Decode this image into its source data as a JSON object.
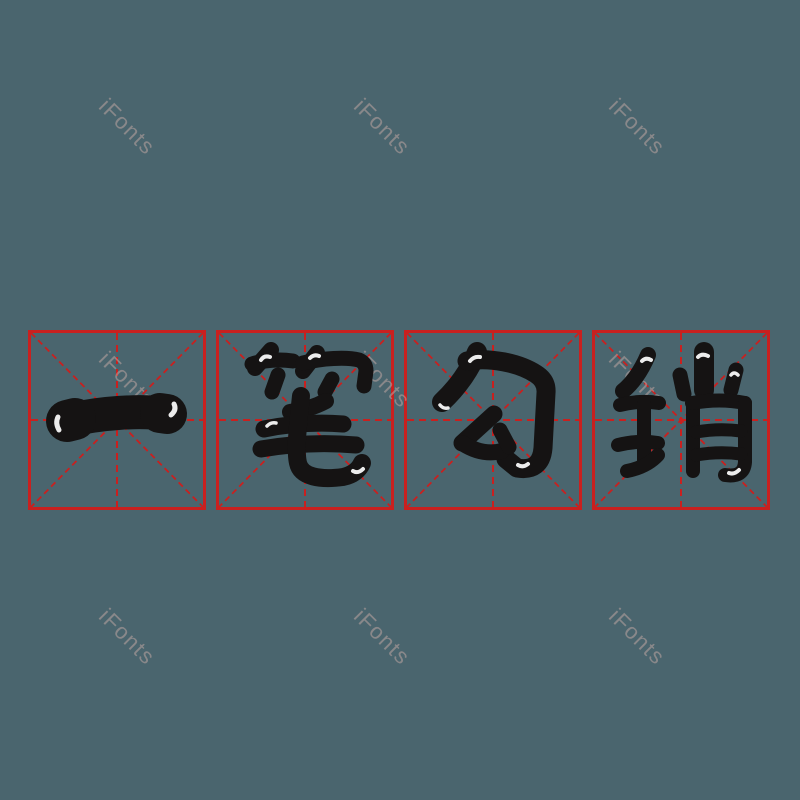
{
  "phrase": {
    "text": "一笔勾销"
  },
  "characters": [
    "一",
    "笔",
    "勾",
    "销"
  ],
  "watermark": {
    "text": "iFonts"
  },
  "grid": {
    "cell_count": 4
  },
  "colors": {
    "background": "#4A656E",
    "grid_red": "#C9201F",
    "ink_black": "#151313",
    "highlight_white": "#FFFFFF",
    "watermark_gray": "rgba(190,165,163,0.55)"
  }
}
